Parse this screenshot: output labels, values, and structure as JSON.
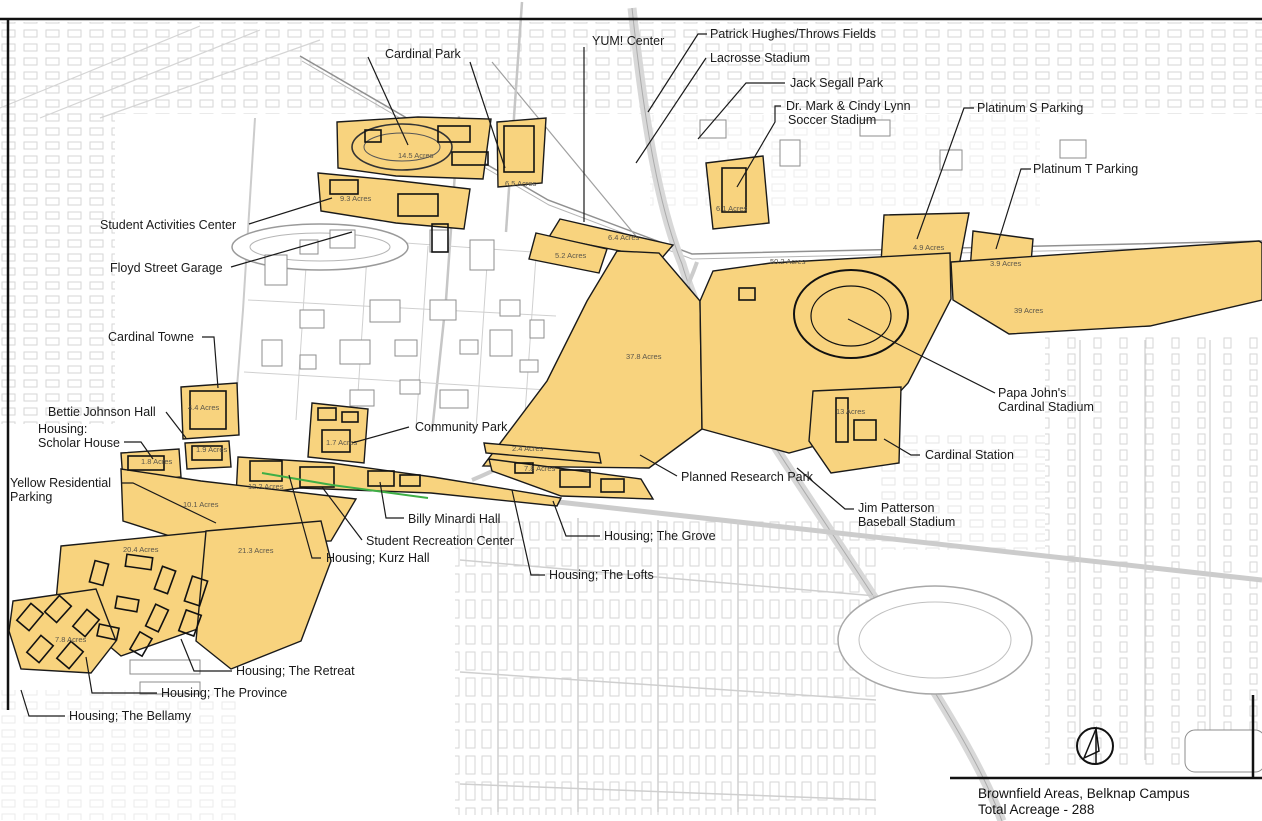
{
  "map_title": "Brownfield Areas, Belknap Campus",
  "caption": {
    "line1": "Brownfield Areas, Belknap Campus",
    "line2": "Total Acreage - 288"
  },
  "colors": {
    "brownfield_fill": "#F8D37E",
    "brownfield_stroke": "#1a1a1a",
    "base_map_gray": "#d6d6d6",
    "label_text": "#1a1a1a",
    "green_boundary": "#3faf46"
  },
  "icons": {
    "north_arrow": "north-arrow-icon"
  },
  "callouts": [
    {
      "id": "cardinal-park",
      "lines": [
        "Cardinal Park"
      ]
    },
    {
      "id": "yum-center",
      "lines": [
        "YUM! Center"
      ]
    },
    {
      "id": "patrick-hughes-throws-fields",
      "lines": [
        "Patrick Hughes/Throws Fields"
      ]
    },
    {
      "id": "lacrosse-stadium",
      "lines": [
        "Lacrosse Stadium"
      ]
    },
    {
      "id": "jack-segall-park",
      "lines": [
        "Jack Segall Park"
      ]
    },
    {
      "id": "soccer-stadium",
      "lines": [
        "Dr. Mark & Cindy Lynn",
        "Soccer Stadium"
      ]
    },
    {
      "id": "platinum-s-parking",
      "lines": [
        "Platinum S Parking"
      ]
    },
    {
      "id": "platinum-t-parking",
      "lines": [
        "Platinum T Parking"
      ]
    },
    {
      "id": "student-activities-center",
      "lines": [
        "Student Activities Center"
      ]
    },
    {
      "id": "floyd-street-garage",
      "lines": [
        "Floyd Street Garage"
      ]
    },
    {
      "id": "cardinal-towne",
      "lines": [
        "Cardinal Towne"
      ]
    },
    {
      "id": "bettie-johnson-hall",
      "lines": [
        "Bettie Johnson Hall"
      ]
    },
    {
      "id": "housing-scholar-house",
      "lines": [
        "Housing:",
        "Scholar House"
      ]
    },
    {
      "id": "yellow-residential-parking",
      "lines": [
        "Yellow Residential",
        "Parking"
      ]
    },
    {
      "id": "community-park",
      "lines": [
        "Community Park"
      ]
    },
    {
      "id": "billy-minardi-hall",
      "lines": [
        "Billy Minardi Hall"
      ]
    },
    {
      "id": "student-recreation-center",
      "lines": [
        "Student Recreation Center"
      ]
    },
    {
      "id": "housing-kurz-hall",
      "lines": [
        "Housing; Kurz Hall"
      ]
    },
    {
      "id": "housing-the-grove",
      "lines": [
        "Housing; The Grove"
      ]
    },
    {
      "id": "housing-the-lofts",
      "lines": [
        "Housing; The Lofts"
      ]
    },
    {
      "id": "planned-research-park",
      "lines": [
        "Planned Research Park"
      ]
    },
    {
      "id": "papa-johns-cardinal-stadium",
      "lines": [
        "Papa John's",
        "Cardinal Stadium"
      ]
    },
    {
      "id": "cardinal-station",
      "lines": [
        "Cardinal Station"
      ]
    },
    {
      "id": "jim-patterson-baseball-stadium",
      "lines": [
        "Jim Patterson",
        "Baseball Stadium"
      ]
    },
    {
      "id": "housing-the-retreat",
      "lines": [
        "Housing; The Retreat"
      ]
    },
    {
      "id": "housing-the-province",
      "lines": [
        "Housing; The Province"
      ]
    },
    {
      "id": "housing-the-bellamy",
      "lines": [
        "Housing; The Bellamy"
      ]
    }
  ],
  "areas": [
    {
      "id": "brownfield-cardinal-park",
      "acres": "14.5 Acres"
    },
    {
      "id": "brownfield-north-small",
      "acres": "6.5 Acres"
    },
    {
      "id": "brownfield-activities-center",
      "acres": "9.3 Acres"
    },
    {
      "id": "brownfield-rail-south",
      "acres": "5.2 Acres"
    },
    {
      "id": "brownfield-rail-north",
      "acres": "6.4 Acres"
    },
    {
      "id": "brownfield-soccer-stadium",
      "acres": "6.1 Acres"
    },
    {
      "id": "brownfield-stadium-west",
      "acres": "50.2 Acres"
    },
    {
      "id": "brownfield-platinum-s",
      "acres": "4.9 Acres"
    },
    {
      "id": "brownfield-platinum-t",
      "acres": "3.9 Acres"
    },
    {
      "id": "brownfield-east-strip",
      "acres": "39 Acres"
    },
    {
      "id": "brownfield-research-park",
      "acres": "37.8 Acres"
    },
    {
      "id": "brownfield-cardinal-station",
      "acres": "13 Acres"
    },
    {
      "id": "brownfield-cardinal-towne",
      "acres": "4.4 Acres"
    },
    {
      "id": "brownfield-bettie-johnson",
      "acres": "1.9 Acres"
    },
    {
      "id": "brownfield-scholar-house",
      "acres": "1.8 Acres"
    },
    {
      "id": "brownfield-kurz-band",
      "acres": "12.2 Acres"
    },
    {
      "id": "brownfield-yellow-lot",
      "acres": "10.1 Acres"
    },
    {
      "id": "brownfield-community-park",
      "acres": "1.7 Acres"
    },
    {
      "id": "brownfield-grove-north",
      "acres": "2.4 Acres"
    },
    {
      "id": "brownfield-grove-south",
      "acres": "7.8 Acres"
    },
    {
      "id": "brownfield-retreat-west",
      "acres": "20.4 Acres"
    },
    {
      "id": "brownfield-retreat-east",
      "acres": "21.3 Acres"
    },
    {
      "id": "brownfield-bellamy",
      "acres": "7.8 Acres"
    }
  ]
}
